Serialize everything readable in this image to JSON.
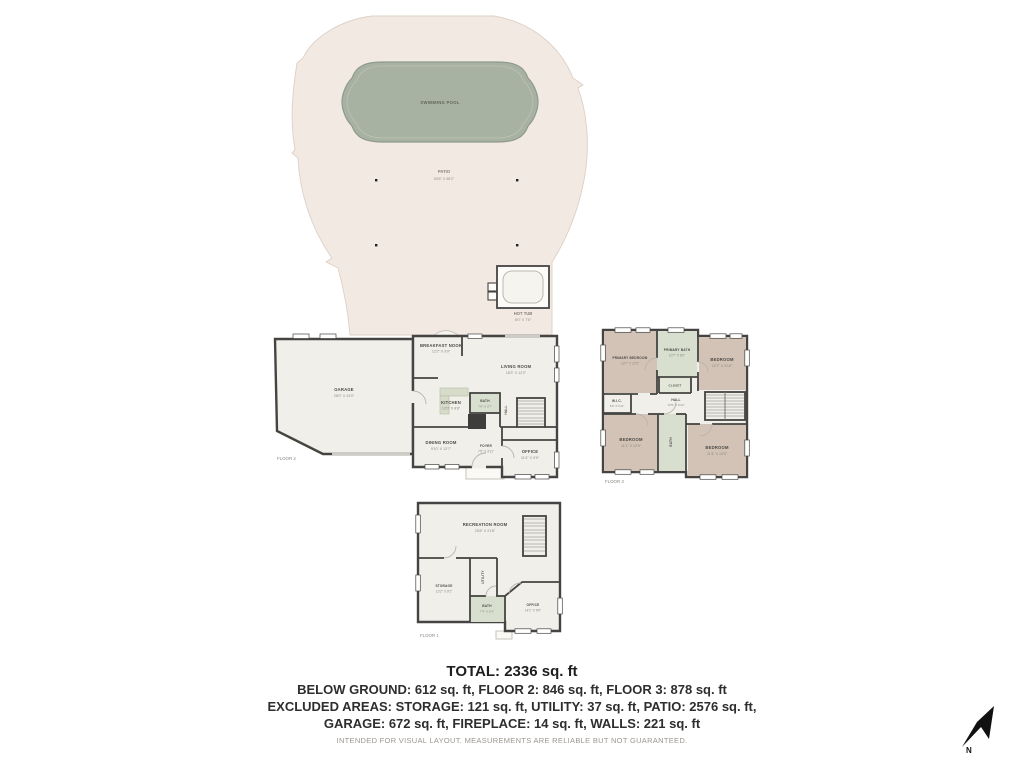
{
  "outdoor": {
    "pool_label": "SWIMMING POOL",
    "patio_label": "PATIO",
    "patio_dims": "53'6\" X 58'2\"",
    "hot_tub_label": "HOT TUB",
    "hot_tub_dims": "8'0\" X 7'6\""
  },
  "floor2": {
    "label": "FLOOR 2",
    "garage": {
      "name": "GARAGE",
      "dims": "28'0\" X 24'0\""
    },
    "breakfast_nook": {
      "name": "BREAKFAST NOOK",
      "dims": "12'2\" X 9'9\""
    },
    "living_room": {
      "name": "LIVING ROOM",
      "dims": "18'3\" X 12'2\""
    },
    "kitchen": {
      "name": "KITCHEN",
      "dims": "12'0\" X 8'8\""
    },
    "dining_room": {
      "name": "DINING ROOM",
      "dims": "9'10\" X 12'7\""
    },
    "bath": {
      "name": "BATH",
      "dims": "7'6\" X 3'7\""
    },
    "hall": {
      "name": "HALL"
    },
    "foyer": {
      "name": "FOYER",
      "dims": "7'9\" X 3'11\""
    },
    "office": {
      "name": "OFFICE",
      "dims": "11'4\" X 9'9\""
    }
  },
  "floor3": {
    "label": "FLOOR 3",
    "primary_bedroom": {
      "name": "PRIMARY BEDROOM",
      "dims": "13'7\" X 12'3\""
    },
    "primary_bath": {
      "name": "PRIMARY BATH",
      "dims": "10'7\" X 8'0\""
    },
    "bedroom_top_right": {
      "name": "BEDROOM",
      "dims": "12'7\" X 9'10\""
    },
    "wic": {
      "name": "W.I.C.",
      "dims": "5'9\" X 3'11\""
    },
    "closet": {
      "name": "CLOSET"
    },
    "hall": {
      "name": "HALL",
      "dims": "13'5\" X 3'10\""
    },
    "bedroom_bottom_left": {
      "name": "BEDROOM",
      "dims": "11'1\" X 12'9\""
    },
    "bath": {
      "name": "BATH"
    },
    "bedroom_bottom_right": {
      "name": "BEDROOM",
      "dims": "11'4\" X 10'5\""
    }
  },
  "floor1": {
    "label": "FLOOR 1",
    "recreation_room": {
      "name": "RECREATION ROOM",
      "dims": "25'8\" X 21'8\""
    },
    "storage": {
      "name": "STORAGE",
      "dims": "13'2\" X 9'2\""
    },
    "utility": {
      "name": "UTILITY"
    },
    "bath": {
      "name": "BATH",
      "dims": "7'4\" X 5'4\""
    },
    "office": {
      "name": "OFFICE",
      "dims": "14'1\" X 9'9\""
    }
  },
  "summary": {
    "total": "TOTAL: 2336 sq. ft",
    "line1": "BELOW GROUND: 612 sq. ft, FLOOR 2: 846 sq. ft, FLOOR 3: 878 sq. ft",
    "line2": "EXCLUDED AREAS: STORAGE: 121 sq. ft, UTILITY: 37 sq. ft, PATIO: 2576 sq. ft,",
    "line3": "GARAGE: 672 sq. ft, FIREPLACE: 14 sq. ft, WALLS: 221 sq. ft",
    "disclaimer": "INTENDED FOR VISUAL LAYOUT. MEASUREMENTS ARE RELIABLE BUT NOT GUARANTEED."
  },
  "compass": {
    "north_label": "N"
  },
  "colors": {
    "patio": "#f2e9e3",
    "pool": "#a8b2a2",
    "floor": "#f0efe9",
    "bedroom": "#d2c3b6",
    "bath": "#d8dfcf",
    "wall": "#454442"
  }
}
